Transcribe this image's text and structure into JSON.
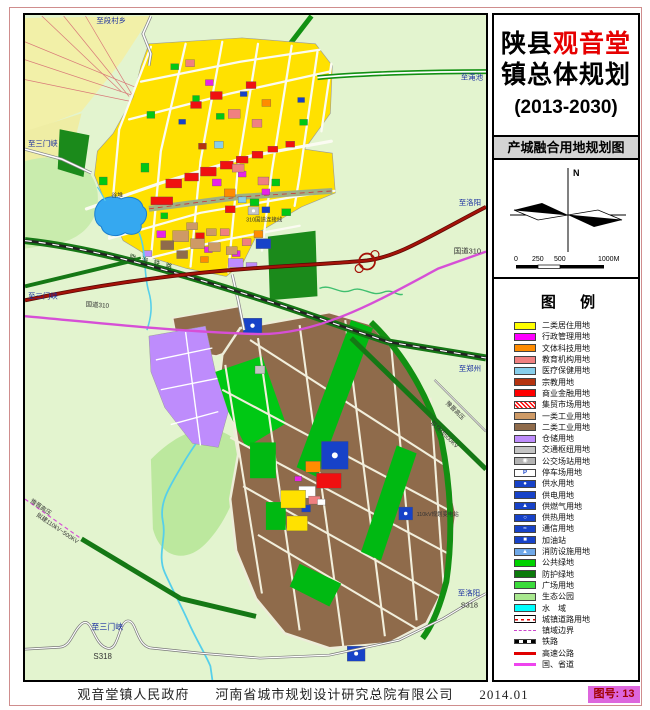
{
  "title": {
    "prefix": "陕县",
    "highlight": "观音堂",
    "line2": "镇总体规划",
    "years": "(2013-2030)"
  },
  "subtitle": "产城融合用地规划图",
  "compass": {
    "north_label": "N"
  },
  "scalebar": {
    "ticks": [
      "0",
      "250",
      "500",
      "1000M"
    ]
  },
  "legend": {
    "heading": "图  例",
    "items": [
      {
        "label": "二类居住用地",
        "color": "#FFFF00",
        "type": "fill"
      },
      {
        "label": "行政管理用地",
        "color": "#FF00FF",
        "type": "fill"
      },
      {
        "label": "文体科技用地",
        "color": "#FF8C00",
        "type": "fill"
      },
      {
        "label": "教育机构用地",
        "color": "#F08080",
        "type": "fill"
      },
      {
        "label": "医疗保健用地",
        "color": "#87CEEB",
        "type": "fill"
      },
      {
        "label": "宗教用地",
        "color": "#B5330F",
        "type": "fill"
      },
      {
        "label": "商业金融用地",
        "color": "#FF0000",
        "type": "fill"
      },
      {
        "label": "集贸市场用地",
        "color": "#FF0000",
        "type": "hatch"
      },
      {
        "label": "一类工业用地",
        "color": "#CE9A66",
        "type": "fill"
      },
      {
        "label": "二类工业用地",
        "color": "#8F6B4B",
        "type": "fill"
      },
      {
        "label": "仓储用地",
        "color": "#BE8CFC",
        "type": "fill"
      },
      {
        "label": "交通枢纽用地",
        "color": "#C4C4C4",
        "type": "fill"
      },
      {
        "label": "公交场站用地",
        "color": "#B4B4B4",
        "type": "fill",
        "icon": "bus"
      },
      {
        "label": "停车场用地",
        "color": "#FFFFFF",
        "type": "fill",
        "icon": "P"
      },
      {
        "label": "供水用地",
        "color": "#1742C8",
        "type": "fill",
        "icon": "drop"
      },
      {
        "label": "供电用地",
        "color": "#1742C8",
        "type": "fill"
      },
      {
        "label": "供燃气用地",
        "color": "#1742C8",
        "type": "fill",
        "icon": "flame"
      },
      {
        "label": "供热用地",
        "color": "#1742C8",
        "type": "fill",
        "icon": "ring"
      },
      {
        "label": "通信用地",
        "color": "#1742C8",
        "type": "fill",
        "icon": "wave"
      },
      {
        "label": "加油站",
        "color": "#1742C8",
        "type": "fill",
        "icon": "pump"
      },
      {
        "label": "消防设施用地",
        "color": "#6FA8E8",
        "type": "fill",
        "icon": "fire"
      },
      {
        "label": "公共绿地",
        "color": "#00D200",
        "type": "fill"
      },
      {
        "label": "防护绿地",
        "color": "#0B7A0B",
        "type": "fill"
      },
      {
        "label": "广场用地",
        "color": "#3BDB3B",
        "type": "fill"
      },
      {
        "label": "生态公园",
        "color": "#A9E88F",
        "type": "fill"
      },
      {
        "label": "水　域",
        "color": "#00FFFF",
        "type": "fill"
      },
      {
        "label": "城镇道路用地",
        "color": "#E00000",
        "type": "road"
      },
      {
        "label": "镇域边界",
        "color": "#CC44CC",
        "type": "boundary"
      },
      {
        "label": "铁路",
        "color": "#000000",
        "type": "railway"
      },
      {
        "label": "高速公路",
        "color": "#E00000",
        "type": "line"
      },
      {
        "label": "国、省道",
        "color": "#EE44EE",
        "type": "line"
      }
    ]
  },
  "map": {
    "labels": [
      {
        "text": "至段村乡"
      },
      {
        "text": "至渑池"
      },
      {
        "text": "至洛阳"
      },
      {
        "text": "国道310"
      },
      {
        "text": "至郑州"
      },
      {
        "text": "豫晋高压"
      },
      {
        "text": "联络线500KV"
      },
      {
        "text": "至洛阳"
      },
      {
        "text": "S318"
      },
      {
        "text": "至三门峡"
      },
      {
        "text": "至三门峡"
      },
      {
        "text": "国道310"
      },
      {
        "text": "豫晋高压"
      },
      {
        "text": "拟建110kV~500KV"
      },
      {
        "text": "至三门峡"
      },
      {
        "text": "S318"
      },
      {
        "text": "谷堆"
      },
      {
        "text": "陇海铁路"
      },
      {
        "text": "310国道连接线"
      },
      {
        "text": "110kV规划变电站"
      }
    ]
  },
  "footer": {
    "gov": "观音堂镇人民政府",
    "company": "河南省城市规划设计研究总院有限公司",
    "date": "2014.01",
    "sheet_label": "图号: 13"
  }
}
